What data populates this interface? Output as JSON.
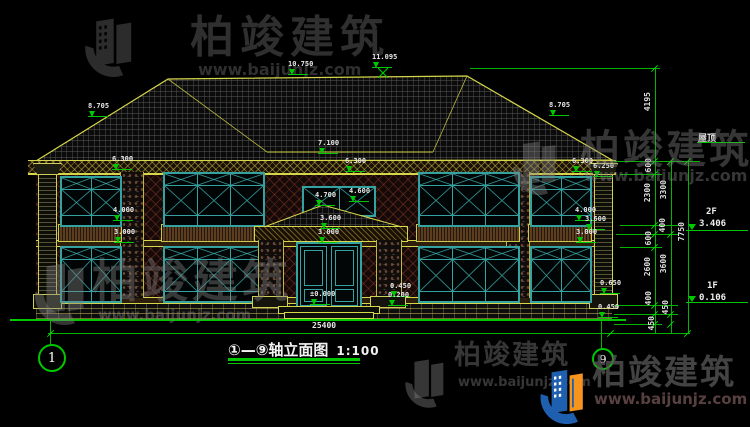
{
  "watermark": {
    "brand": "柏竣建筑",
    "url": "www.baijunjz.com"
  },
  "title": {
    "name": "①—⑨轴立面图",
    "scale": "1:100"
  },
  "axes": {
    "left": "1",
    "right": "9"
  },
  "levels": {
    "v10750": "10.750",
    "v11095": "11.095",
    "v8705": "8.705",
    "v7100": "7.100",
    "v6300": "6.300",
    "v6250": "6.250",
    "v4700": "4.700",
    "v4600": "4.600",
    "v4000": "4.000",
    "v3600": "3.600",
    "v3000": "3.000",
    "v0650": "0.650",
    "v0450": "0.450",
    "v0200": "0.200",
    "v0000": "±0.000"
  },
  "vdims": {
    "d4195": "4195",
    "d3300": "3300",
    "d3600": "3600",
    "d2300": "2300",
    "d2600": "2600",
    "d600": "600",
    "d400": "400",
    "d450": "450",
    "d7750": "7750"
  },
  "hdims": {
    "total": "25400"
  },
  "floors": {
    "roof": "屋顶",
    "f2": "2F",
    "f2_elev": "3.406",
    "f1": "1F",
    "f1_elev": "0.106"
  }
}
